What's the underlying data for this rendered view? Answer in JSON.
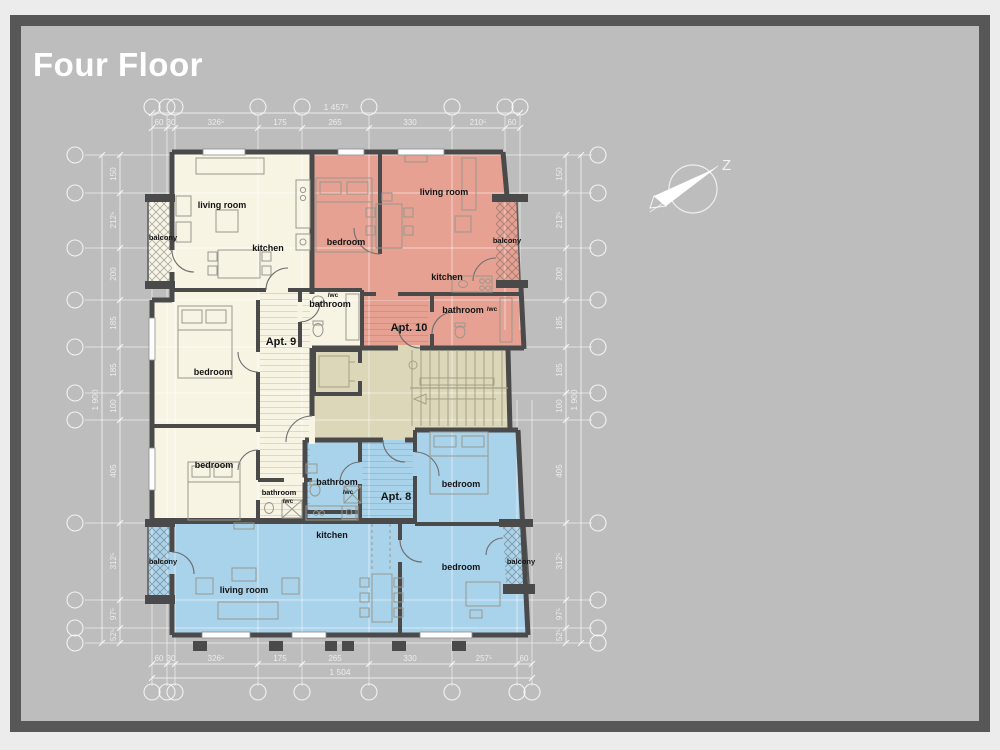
{
  "window": {
    "title": "Four Floor"
  },
  "compass": {
    "north_label": "Z"
  },
  "apartments": {
    "apt9": {
      "label": "Apt. 9",
      "living_room": "living room",
      "kitchen": "kitchen",
      "balcony": "balcony",
      "bathroom": "bathroom",
      "bathroom_wc": "/wc",
      "bedroom_1": "bedroom",
      "bedroom_2": "bedroom",
      "bathroom_2": "bathroom",
      "bathroom_2_wc": "/wc"
    },
    "apt10": {
      "label": "Apt. 10",
      "bedroom": "bedroom",
      "living_room": "living room",
      "kitchen": "kitchen",
      "balcony": "balcony",
      "bathroom": "bathroom",
      "bathroom_wc": "/wc"
    },
    "apt8": {
      "label": "Apt. 8",
      "bathroom": "bathroom",
      "bathroom_wc": "/wc",
      "bedroom_1": "bedroom",
      "kitchen": "kitchen",
      "living_room": "living room",
      "bedroom_2": "bedroom",
      "balcony_left": "balcony",
      "balcony_right": "balcony"
    }
  },
  "dimensions": {
    "top": {
      "segments": [
        "60",
        "30",
        "326⁵",
        "175",
        "265",
        "330",
        "210⁵",
        "60"
      ],
      "total": "1 457⁵"
    },
    "bottom": {
      "segments": [
        "60",
        "30",
        "326⁵",
        "175",
        "265",
        "330",
        "257⁵",
        "60"
      ],
      "total": "1 504"
    },
    "left": {
      "segments": [
        "150",
        "212⁵",
        "200",
        "185",
        "185",
        "100",
        "405",
        "312⁵",
        "97⁵",
        "52⁵"
      ],
      "total": "1 900"
    },
    "right": {
      "segments": [
        "150",
        "212⁵",
        "200",
        "185",
        "185",
        "100",
        "405",
        "312⁵",
        "97⁵",
        "52⁵"
      ],
      "total": "1 900"
    }
  },
  "colors": {
    "apt9_fill": "#f8f4e4",
    "apt10_fill": "#e7a192",
    "apt8_fill": "#a9d2eb",
    "common_fill": "#dbd7b8",
    "wall": "#4a4a4a",
    "background": "#bdbdbd",
    "frame": "#575757"
  }
}
